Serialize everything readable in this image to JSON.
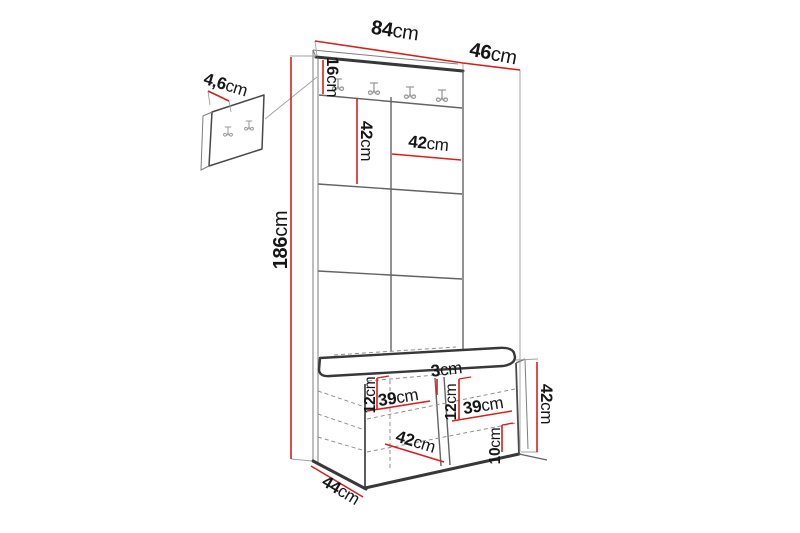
{
  "diagram": {
    "subject": "hallway-furniture-set-dimension-drawing",
    "unit_system": "cm"
  },
  "dims": {
    "total_width": {
      "value": "84",
      "unit": "cm"
    },
    "total_depth": {
      "value": "46",
      "unit": "cm"
    },
    "total_height": {
      "value": "186",
      "unit": "cm"
    },
    "hook_board_height": {
      "value": "16",
      "unit": "cm"
    },
    "wall_panel_thickness": {
      "value": "4,6",
      "unit": "cm"
    },
    "tile_height": {
      "value": "42",
      "unit": "cm"
    },
    "tile_width": {
      "value": "42",
      "unit": "cm"
    },
    "divider_thickness": {
      "value": "3",
      "unit": "cm"
    },
    "left_top_inset": {
      "value": "12",
      "unit": "cm"
    },
    "left_compartment_width": {
      "value": "39",
      "unit": "cm"
    },
    "right_top_inset": {
      "value": "12",
      "unit": "cm"
    },
    "right_compartment_width": {
      "value": "39",
      "unit": "cm"
    },
    "bench_height": {
      "value": "42",
      "unit": "cm"
    },
    "plinth_height": {
      "value": "10",
      "unit": "cm"
    },
    "bench_interior_depth": {
      "value": "42",
      "unit": "cm"
    },
    "bench_depth": {
      "value": "44",
      "unit": "cm"
    }
  },
  "colors": {
    "dimension_red": "#d6201f",
    "outline_dark": "#383838",
    "label_text": "#161616",
    "background": "#ffffff"
  }
}
